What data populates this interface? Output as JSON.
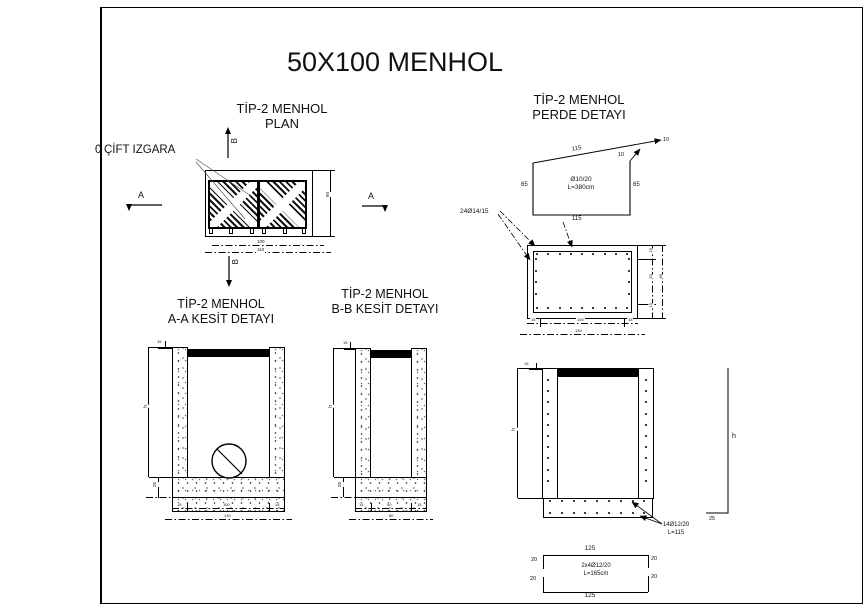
{
  "sheet": {
    "title": "50X100 MENHOL"
  },
  "plan": {
    "title1": "TİP-2 MENHOL",
    "title2": "PLAN",
    "grate_label_clip": "0",
    "grate_label": "ÇİFT IZGARA",
    "marker_a": "A",
    "marker_b": "B",
    "dim_inner": "100",
    "dim_outer": "110",
    "dim_side": "60"
  },
  "perde": {
    "title1": "TİP-2 MENHOL",
    "title2": "PERDE DETAYI",
    "dim_top": "115",
    "dim_bottom": "115",
    "dim_left": "65",
    "dim_right": "65",
    "hook_top": "10",
    "hook_right": "10",
    "bar1": "Ø10/20",
    "bar2": "L=380cm",
    "rebar_label": "24Ø14/15",
    "dim_r1": "15",
    "dim_r2": "50",
    "dim_r3": "15",
    "dim_rt": "80",
    "dim_b1": "15",
    "dim_b2": "100",
    "dim_b3": "15",
    "dim_bt": "130"
  },
  "aa": {
    "title1": "TİP-2 MENHOL",
    "title2": "A-A KESİT DETAYI",
    "dim_h": "h",
    "dim_base": "25",
    "dim_top": "15",
    "dim_b1": "15",
    "dim_b2": "100",
    "dim_b3": "15",
    "dim_bt": "130"
  },
  "bb": {
    "title1": "TİP-2 MENHOL",
    "title2": "B-B KESİT DETAYI",
    "dim_h": "h",
    "dim_base": "25",
    "dim_top": "15",
    "dim_b1": "15",
    "dim_b2": "50",
    "dim_b3": "15",
    "dim_bt": "80"
  },
  "elev": {
    "dim_h": "h",
    "dim_top": "15",
    "bar_label1": "14Ø12/20",
    "bar_label2": "L=115",
    "shape_h": "h",
    "shape_foot": "25"
  },
  "bar_detail": {
    "dim_top": "125",
    "dim_bottom": "125",
    "hook_tl": "20",
    "hook_tr": "20",
    "hook_bl": "20",
    "hook_br": "20",
    "text1": "2x4Ø12/20",
    "text2": "L=165cm"
  }
}
